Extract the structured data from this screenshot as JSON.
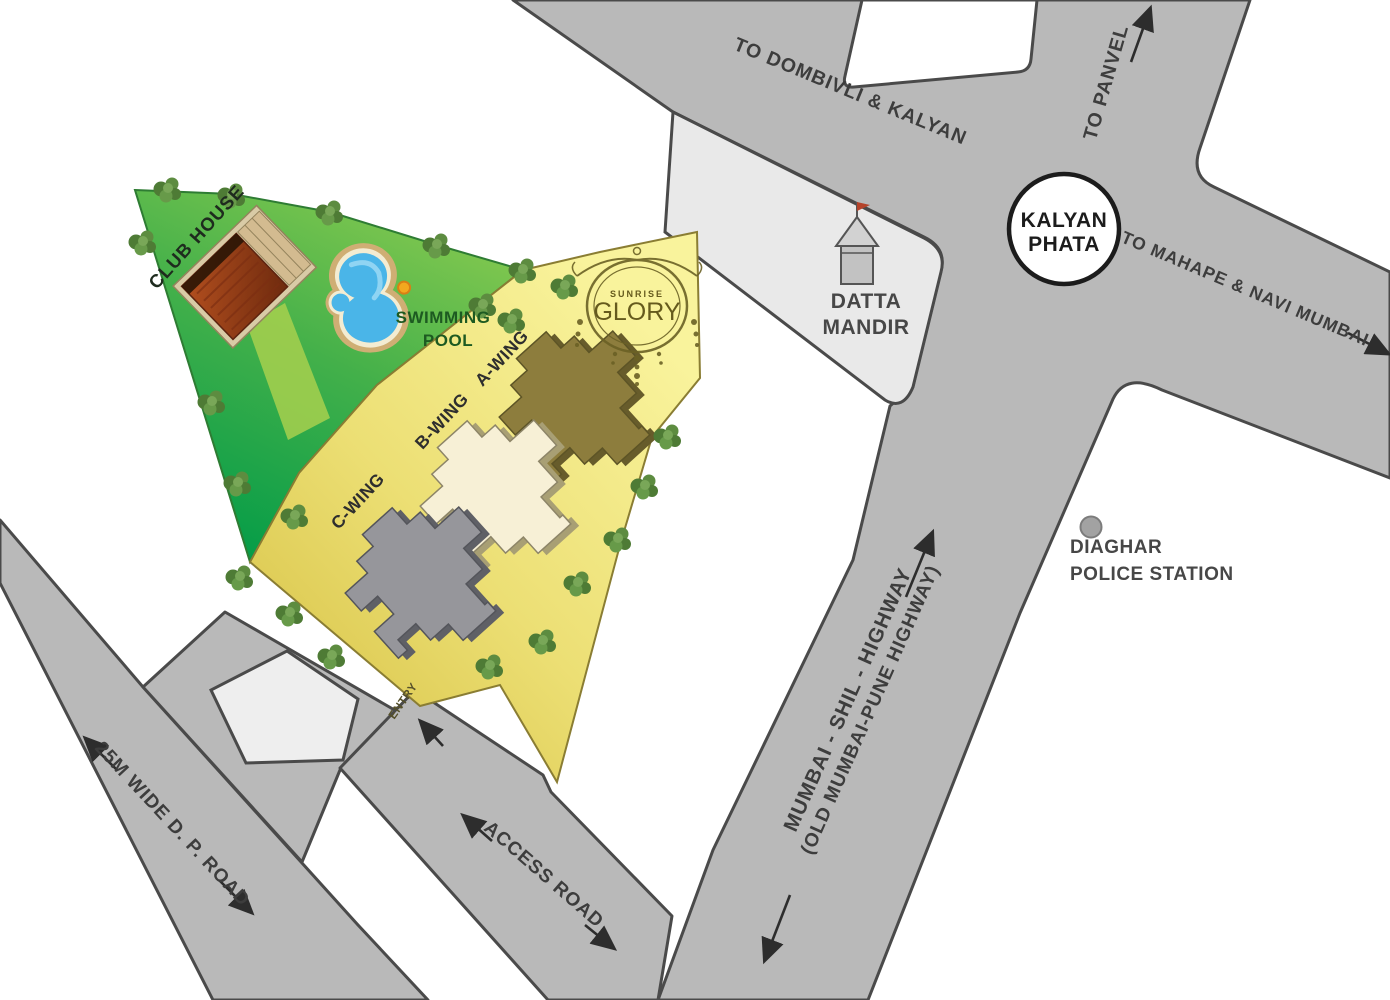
{
  "map": {
    "title": "Sunrise Glory location map",
    "roads": {
      "dombivli": "TO DOMBIVLI & KALYAN",
      "panvel": "TO PANVEL",
      "mahape": "TO MAHAPE & NAVI MUMBAI",
      "highway_line1": "MUMBAI - SHIL - HIGHWAY",
      "highway_line2": "(OLD MUMBAI-PUNE HIGHWAY)",
      "dp_road": "25M WIDE D. P. ROAD",
      "access_road": "ACCESS ROAD",
      "entry": "ENTRY"
    },
    "junction": {
      "line1": "KALYAN",
      "line2": "PHATA"
    },
    "landmarks": {
      "mandir_line1": "DATTA",
      "mandir_line2": "MANDIR",
      "police_line1": "DIAGHAR",
      "police_line2": "POLICE STATION"
    },
    "site": {
      "club_house": "CLUB HOUSE",
      "swimming_line1": "SWIMMING",
      "swimming_line2": "POOL",
      "wing_a": "A-WING",
      "wing_b": "B-WING",
      "wing_c": "C-WING",
      "logo_line1": "SUNRISE",
      "logo_line2": "GLORY"
    },
    "colors": {
      "road_fill": "#b9b9b9",
      "road_stroke": "#4a4a4a",
      "plot_light": "#e9e9e9",
      "lawn_green_dark": "#009b48",
      "lawn_green_light": "#82c74e",
      "site_yellow_light": "#f8f297",
      "site_yellow_dark": "#dbc84e",
      "wing_a_fill": "#8d7d3d",
      "wing_b_fill": "#f7f0d6",
      "wing_c_fill": "#96969b",
      "pool_water": "#4ab5e8",
      "flag_red": "#b5432a"
    }
  }
}
